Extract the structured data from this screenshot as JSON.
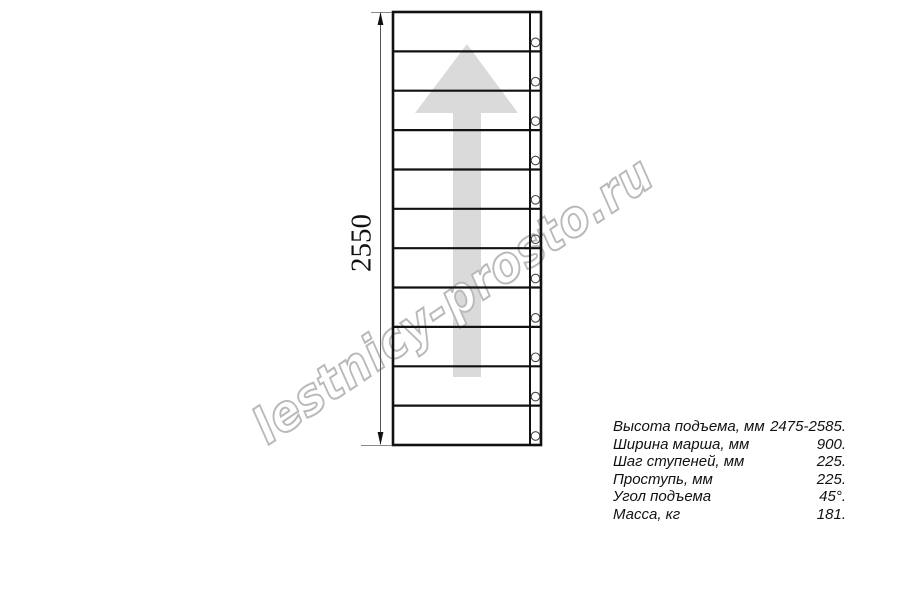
{
  "watermark": {
    "text": "lestnicy-prosto.ru",
    "stroke_color": "#b9b9b9"
  },
  "dimension": {
    "height_label": "2550"
  },
  "drawing": {
    "treads_count": 11,
    "bolts_count": 11,
    "line_color": "#111111",
    "arrow_color": "#dadada"
  },
  "specs": {
    "rows": [
      {
        "label": "Высота подъема, мм",
        "value": "2475-2585."
      },
      {
        "label": "Ширина марша, мм",
        "value": "900."
      },
      {
        "label": "Шаг ступеней, мм",
        "value": "225."
      },
      {
        "label": "Проступь, мм",
        "value": "225."
      },
      {
        "label": "Угол подъема",
        "value": "45°."
      },
      {
        "label": "Масса, кг",
        "value": "181."
      }
    ]
  }
}
